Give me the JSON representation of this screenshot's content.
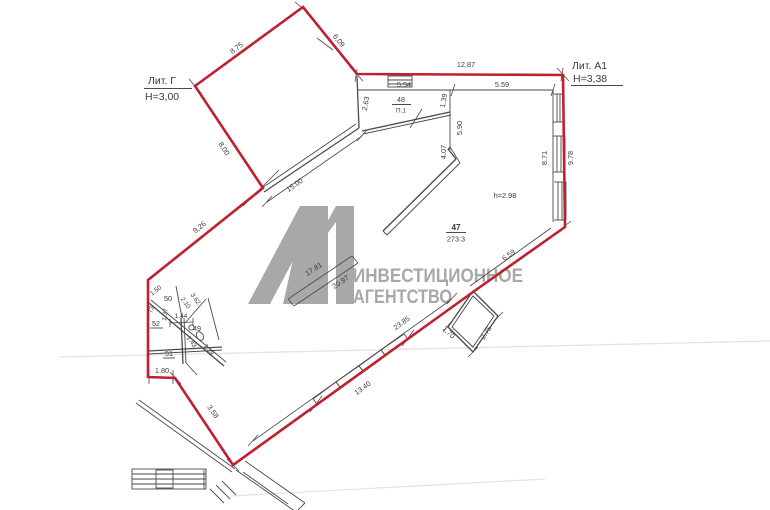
{
  "buildings": {
    "lit_g": {
      "name": "Лит. Г",
      "height": "Н=3,00"
    },
    "lit_a1": {
      "name": "Лит. А1",
      "height": "Н=3,38"
    }
  },
  "rooms": {
    "r47": {
      "num": "47",
      "area": "273.3",
      "ceiling_height": "h=2.98"
    },
    "r48": {
      "num": "48",
      "name": "П.1"
    },
    "r49": {
      "num": "49"
    },
    "r50": {
      "num": "50"
    },
    "r51": {
      "num": "51"
    },
    "r52": {
      "num": "52"
    }
  },
  "dimensions": {
    "d875": "8.75",
    "d609": "6,09",
    "d1287": "12,87",
    "d554": "5.54",
    "d559": "5.59",
    "d263": "2.63",
    "d139": "1.39",
    "d590": "5.90",
    "d407": "4.07",
    "d871": "8.71",
    "d978": "9.78",
    "d800": "8,00",
    "d1500": "15.00",
    "d926": "9,26",
    "d1781": "17.81",
    "d2097": "20.97",
    "d659": "6.59",
    "d2385": "23.85",
    "d1340": "13.40",
    "d170": "1,70",
    "d275": "2.75",
    "d358": "3,58",
    "d180": "1.80",
    "d150": "1.50",
    "d073": "73",
    "d137": "1.37",
    "d210": "2.10",
    "d362": "3.62",
    "d144": "1.44",
    "d143": "1.43",
    "d118": "1.18"
  },
  "watermark": {
    "logo": "А1",
    "line1": "ИНВЕСТИЦИОННОЕ",
    "line2": "АГЕНТСТВО"
  },
  "colors": {
    "boundary": "#bf2030",
    "lines": "#4c4a47",
    "text": "#3d3b38",
    "watermark": "#a8a8a8",
    "background": "#ffffff"
  }
}
